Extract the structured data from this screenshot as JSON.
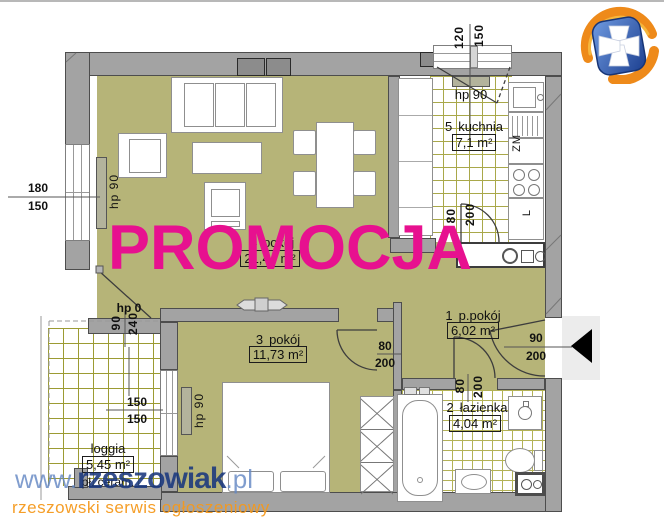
{
  "promo_overlay": {
    "text": "PROMOCJA"
  },
  "watermark": {
    "prefix": "www.",
    "name": "rzeszowiak",
    "tld": ".pl",
    "tagline": "rzeszowski serwis ogłoszeniowy"
  },
  "rooms": {
    "living": {
      "number": "4",
      "name": "pokój",
      "area": "21,44 m²"
    },
    "kitchen": {
      "number": "5",
      "name": "kuchnia",
      "area": "7,1 m²"
    },
    "room3": {
      "number": "3",
      "name": "pokój",
      "area": "11,73 m²"
    },
    "hall": {
      "number": "1",
      "name": "p.pokój",
      "area": "6,02 m²"
    },
    "bath": {
      "number": "2",
      "name": "łazienka",
      "area": "4,04 m²"
    },
    "loggia": {
      "name": "loggia",
      "area": "5,45 m²",
      "floor_note": "pł. ceram."
    }
  },
  "dimensions": {
    "top_window": {
      "w": "120",
      "h": "150"
    },
    "left_window": {
      "w": "180",
      "h": "150"
    },
    "loggia_window": {
      "w": "150",
      "h": "150"
    },
    "balcony_door": {
      "label": "hp 0",
      "w": "90",
      "h": "240"
    },
    "kitchen_door": {
      "w": "80",
      "h": "200"
    },
    "room3_door": {
      "w": "80",
      "h": "200"
    },
    "bath_door": {
      "w": "80",
      "h": "200"
    },
    "entrance_door": {
      "w": "90",
      "h": "200"
    }
  },
  "radiators": {
    "living": "hp 90",
    "kitchen": "hp 90",
    "room3": "hp 90"
  },
  "appliances": {
    "dishwasher": "ZM",
    "fridge": "L"
  },
  "palette": {
    "promo_magenta": "#e7118f",
    "floor_olive": "#b6b478",
    "wall_gray": "#a3a3a3",
    "watermark_blue": "#1f407e",
    "watermark_light_blue": "#6487c3",
    "watermark_orange": "#f4991c",
    "logo_blue": "#2e62b4",
    "logo_orange": "#ef8c1a"
  }
}
